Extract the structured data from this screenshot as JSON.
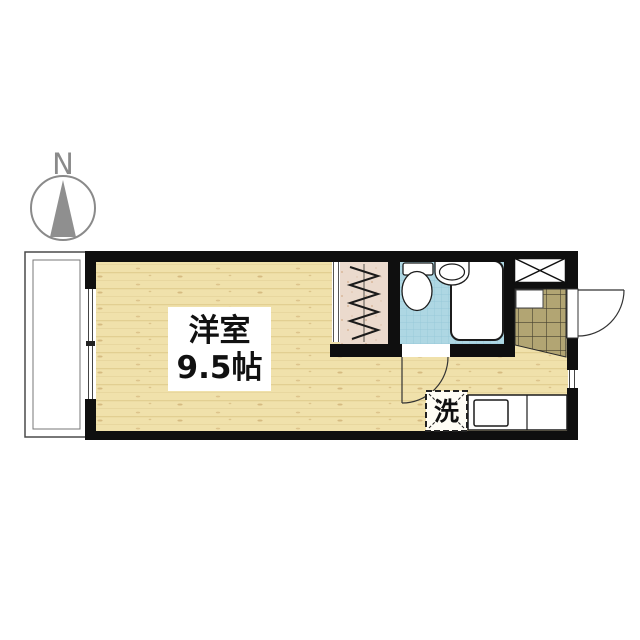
{
  "compass": {
    "label": "N"
  },
  "room": {
    "name": "洋室",
    "size": "9.5帖"
  },
  "laundry": {
    "label": "洗"
  },
  "colors": {
    "wall": "#0f0f0f",
    "wood_floor": "#f0e1ab",
    "wood_grain": "#e2cf92",
    "bath_tile": "#aed7e3",
    "bath_tile_grid": "#92c6d7",
    "entrance_tile": "#b2a573",
    "entrance_tile_grid": "#45402e",
    "closet_fill": "#ebdacd",
    "closet_speckle": "#d2ad8c",
    "fixture_outline": "#1c1c1c",
    "compass_gray": "#8a8a8a"
  }
}
